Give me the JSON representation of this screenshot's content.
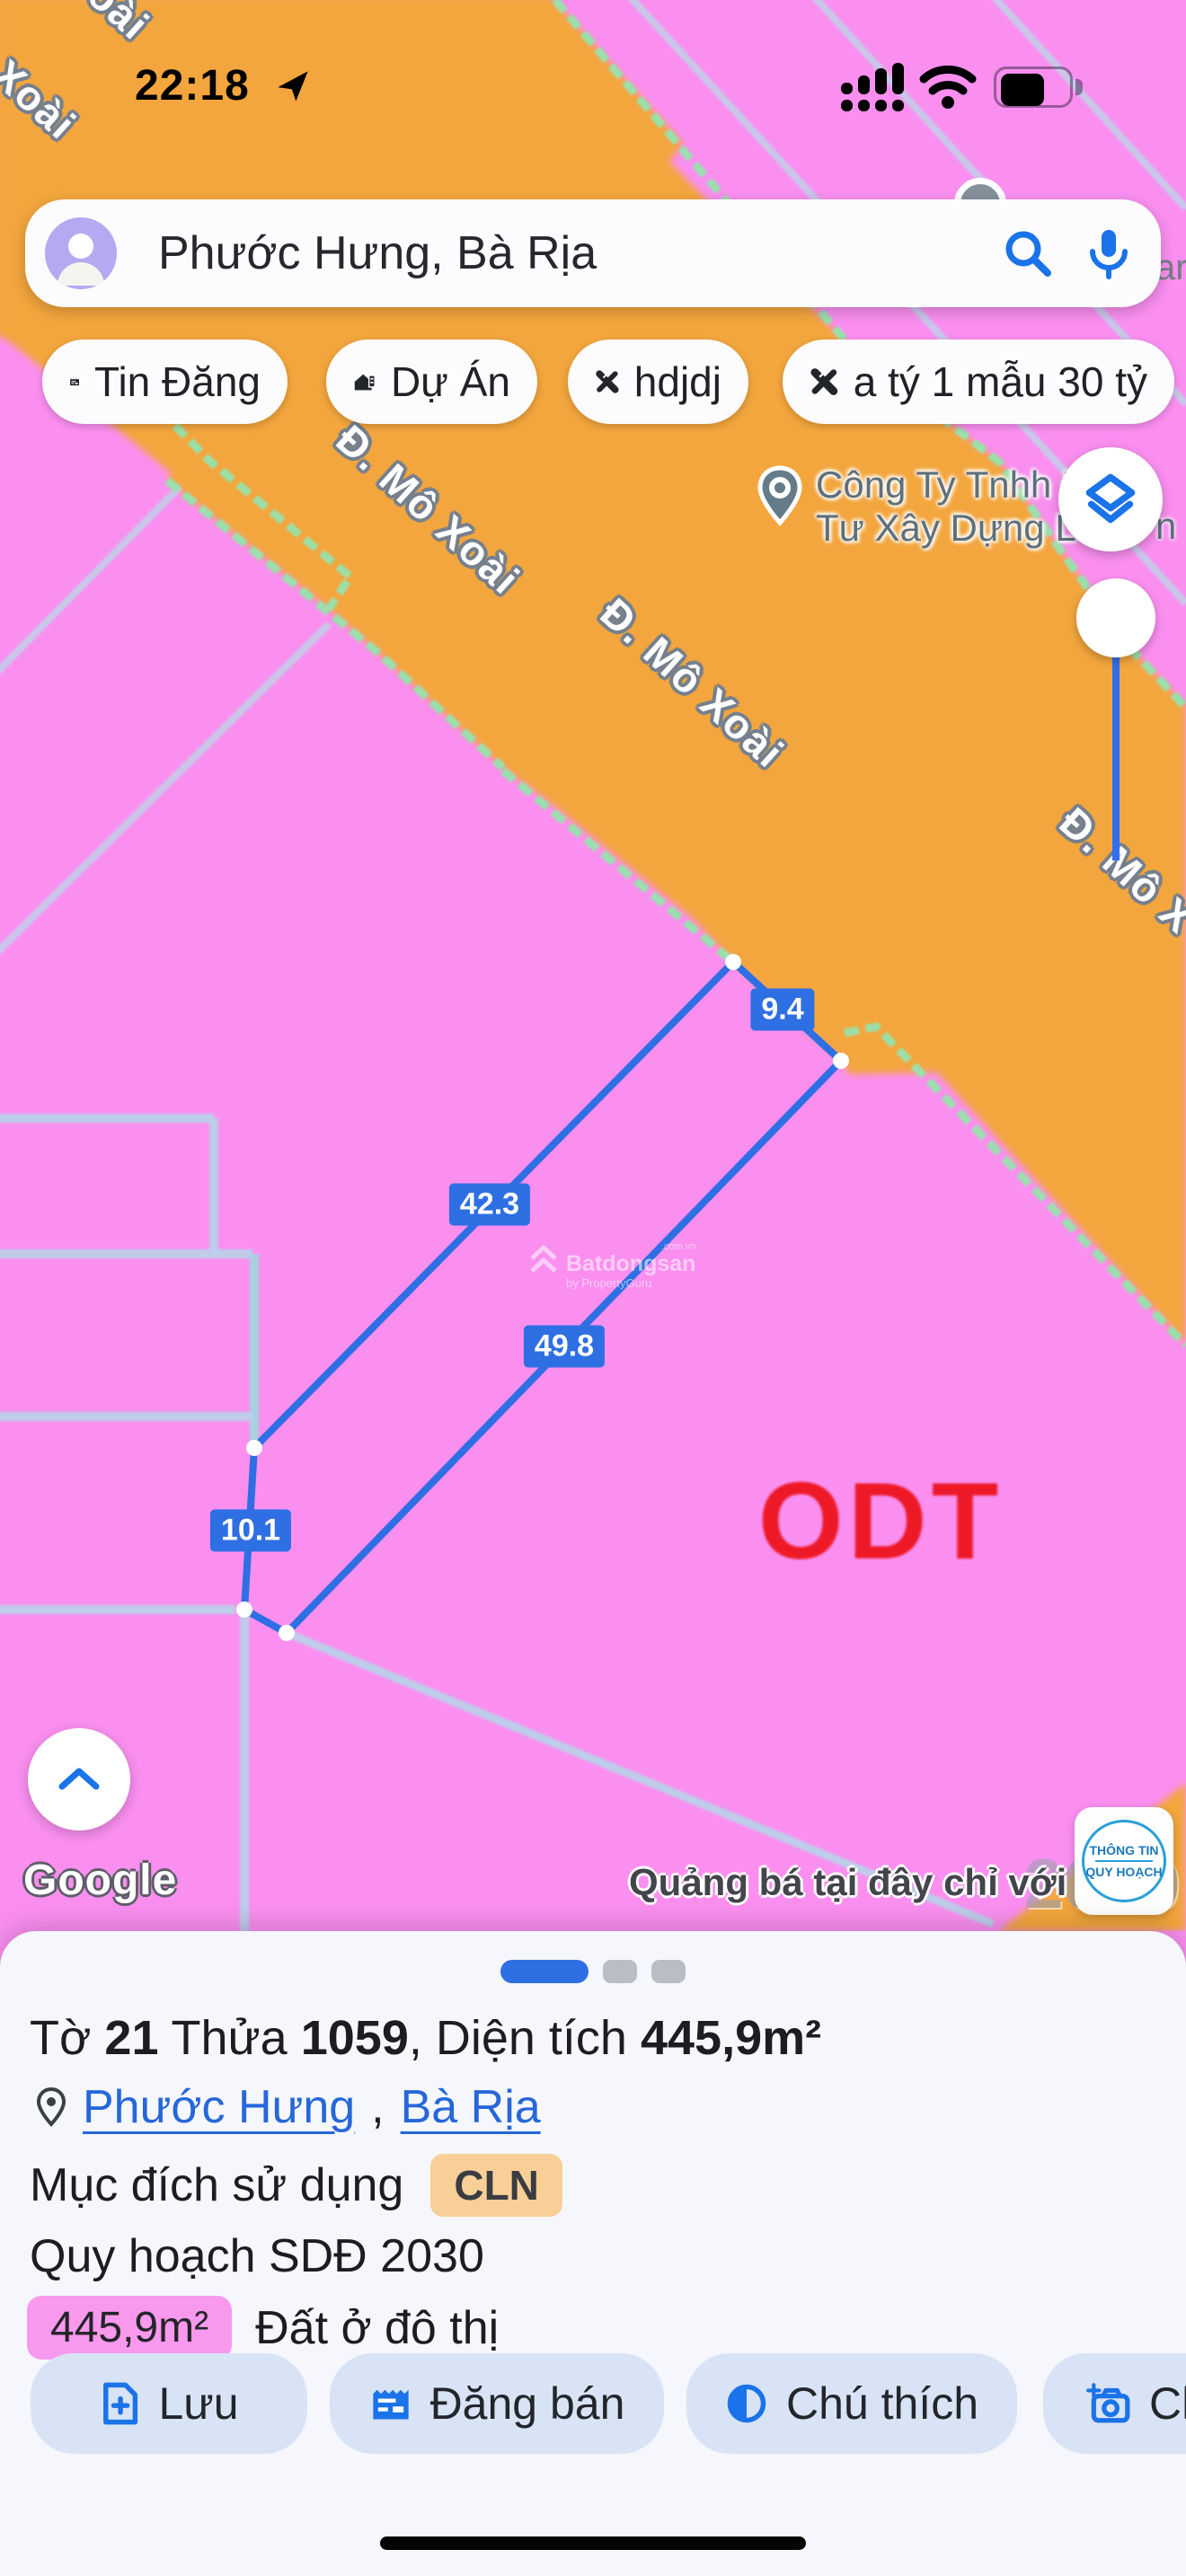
{
  "status_bar": {
    "time": "22:18"
  },
  "search": {
    "query": "Phước Hưng, Bà Rịa"
  },
  "chips": [
    {
      "icon": "newspaper-icon",
      "label": "Tin Đăng"
    },
    {
      "icon": "house-sign-icon",
      "label": "Dự Án"
    },
    {
      "icon": "ruler-pencil-icon",
      "label": "hdjdj"
    },
    {
      "icon": "ruler-pencil-icon",
      "label": "a tý 1 mẫu 30 tỷ"
    }
  ],
  "map": {
    "road_labels": {
      "fragment_top": "oài",
      "fragment_left": "Xoài",
      "label_upper": "Đ. Mô Xoài",
      "label_mid": "Đ. Mô Xoài",
      "label_right": "Đ. Mô X",
      "fragment_search": "ar"
    },
    "poi": {
      "line1": "Công Ty Tnhh Đ",
      "line2": "Tư Xây Dựng Lê",
      "overflow": "n"
    },
    "measurements": {
      "top": "9.4",
      "left": "42.3",
      "right": "49.8",
      "bottom": "10.1"
    },
    "zone_code": "ODT",
    "watermark": {
      "domain": ".com.vn",
      "brand": "Batdongsan",
      "byline": "by PropertyGuru",
      "faint_year": "2030"
    },
    "google_logo": "Google",
    "ad_text": "Quảng bá tại đây chỉ với",
    "planning_badge": {
      "line1": "THÔNG TIN",
      "line2": "QUY HOẠCH"
    }
  },
  "bottom_sheet": {
    "title": {
      "p1": "Tờ ",
      "sheet_no": "21",
      "p2": " Thửa ",
      "plot_no": "1059",
      "p3": ", Diện tích ",
      "area": "445,9m²"
    },
    "location": {
      "ward": "Phước Hưng",
      "separator": ",",
      "city": "Bà Rịa"
    },
    "purpose": {
      "label": "Mục đích sử dụng",
      "badge": "CLN"
    },
    "plan": "Quy hoạch SDĐ 2030",
    "zoning": {
      "area": "445,9m²",
      "label": "Đất ở đô thị"
    },
    "actions": [
      {
        "icon": "save-file-icon",
        "label": "Lưu"
      },
      {
        "icon": "post-listing-icon",
        "label": "Đăng bán"
      },
      {
        "icon": "legend-contrast-icon",
        "label": "Chú thích"
      },
      {
        "icon": "camera-plus-icon",
        "label": "Ch"
      }
    ]
  },
  "colors": {
    "accent": "#1a73e8",
    "parcel_blue": "#2e6fe3",
    "zone_orange": "#f3a63d",
    "zone_pink": "#fa8ff0",
    "odt_red": "#ee1118"
  }
}
